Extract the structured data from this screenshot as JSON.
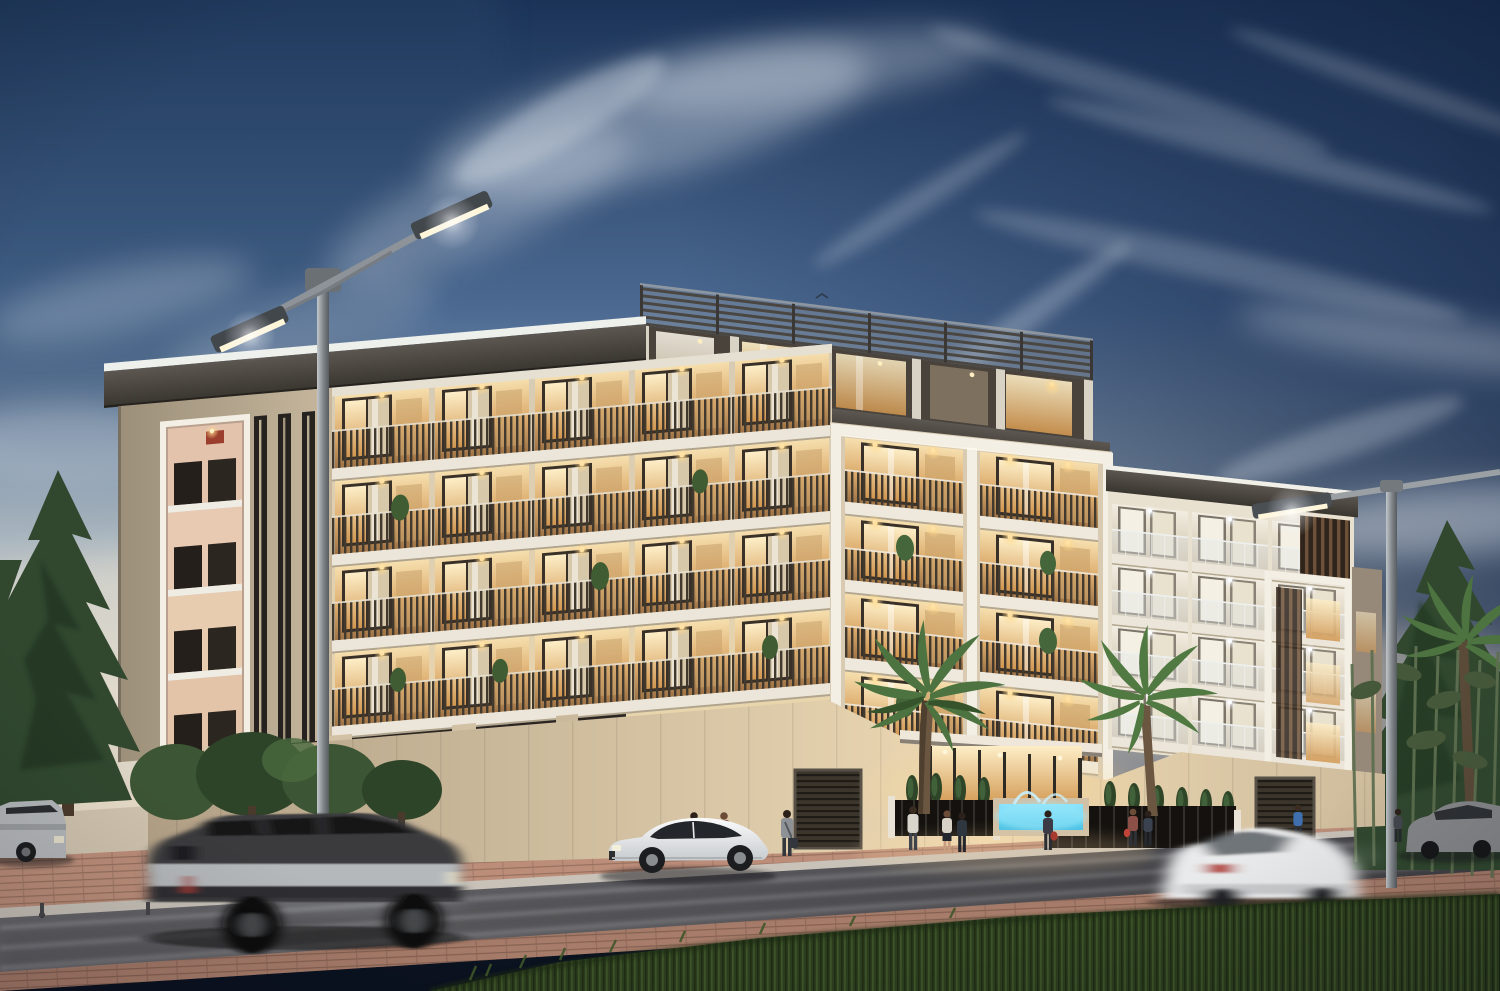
{
  "scene": {
    "type": "architectural-rendering",
    "description": "Luxury low-rise residential apartment building at dusk with warm lit balconies, rooftop pergola terrace, palm trees, street lamps, pedestrians and passing cars on a divided street",
    "time_of_day": "dusk",
    "weather": "clear with wispy cirrus clouds"
  },
  "palette": {
    "sky_top": "#1b3357",
    "sky_mid": "#4c6a92",
    "sky_low": "#aab6bf",
    "sky_horizon": "#d9d2c4",
    "cloud_white": "#eef3f8",
    "facade_stone": "#d8cbb4",
    "facade_stone_warm": "#e9d5ac",
    "frame_white": "#f3efe5",
    "fascia_dark": "#4e4a45",
    "railing_slat": "#42392e",
    "interior_glow": "#f6dfae",
    "glass_warm_deep": "#d1964f",
    "window_cool": "#f2ede1",
    "pergola_gray": "#5a5550",
    "grass_green": "#2c3d1f",
    "road_asphalt": "#58585c",
    "brick_paving": "#b98a76",
    "pool_water": "#45c2e8",
    "lamp_glow": "#fff6da",
    "pine_green": "#31482f",
    "palm_green": "#4d7440",
    "car_white": "#f2f3f4",
    "car_silver": "#b4b7ba",
    "car_dark": "#3a3a3c",
    "taillight_red": "#a83a30"
  },
  "objects": {
    "building_floors_visible": 5,
    "rooftop_pergola": true,
    "balcony_bays_left_wing": 5,
    "center_framed_bays": 2,
    "right_wing_bays": 3,
    "street_lamps": 2,
    "palm_trees": 3,
    "pine_trees": 2,
    "pedestrians": 11,
    "cars_moving": 2,
    "cars_parked": 3,
    "water_feature": true,
    "entrance_canopy": true
  }
}
